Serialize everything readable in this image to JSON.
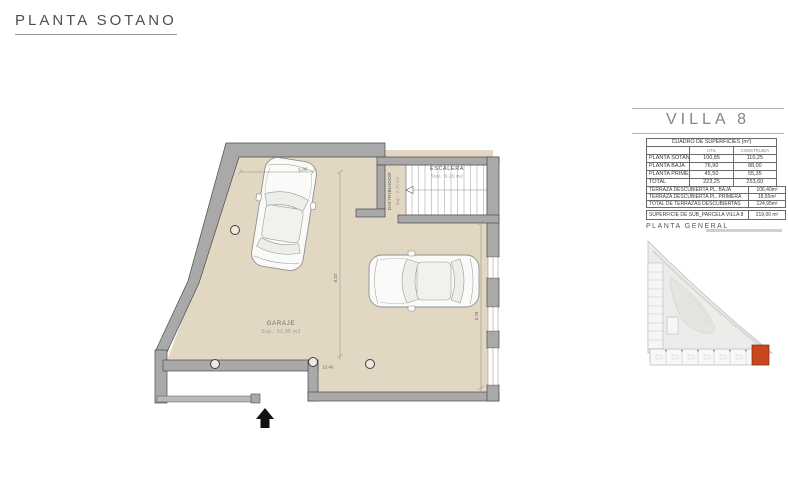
{
  "title": "PLANTA SOTANO",
  "plan": {
    "garage": {
      "label": "GARAJE",
      "area": "Sup.: 91,95 m2"
    },
    "stairs": {
      "label": "ESCALERA",
      "area": "Sup.: 6,20  m2"
    },
    "hall": {
      "label": "DISTRIBUIDOR",
      "area": "Sup.: 2,70 m2"
    },
    "dims": {
      "top": "5.00",
      "mid_vertical": "8.23",
      "right_vertical": "6.78",
      "bottom": "13.40"
    }
  },
  "panel": {
    "villa_title": "VILLA 8",
    "surfaces": {
      "header": "CUADRO DE SUPERFICIES (m²)",
      "columns": {
        "util": "UTIL",
        "construida": "CONSTRUIDA"
      },
      "rows": [
        {
          "label": "PLANTA SOTANO",
          "util": "100,85",
          "construida": "110,25"
        },
        {
          "label": "PLANTA BAJA",
          "util": "76,90",
          "construida": "88,00"
        },
        {
          "label": "PLANTA PRIMERA",
          "util": "45,50",
          "construida": "55,35"
        },
        {
          "label": "TOTAL",
          "util": "223,25",
          "construida": "253,60"
        }
      ]
    },
    "terraces": {
      "rows": [
        {
          "label": "TERRAZA DESCUBIERTA PL. BAJA",
          "value": "106,40m²"
        },
        {
          "label": "TERRAZA DESCUBIERTA PL. PRIMERA",
          "value": "18,55m²"
        },
        {
          "label": "TOTAL DE TERRAZAS DESCUBIERTAS",
          "value": "124,95m²"
        }
      ]
    },
    "parcel": {
      "label": "SUPERFICIE DE SUB_PARCELA VILLA 8",
      "value": "219,00 m²"
    },
    "site_plan_title": "PLANTA GENERAL"
  },
  "colors": {
    "floor": "#e1d7c2",
    "wall": "#a9a9a9",
    "wall_edge": "#4a4a4a",
    "highlight_villa": "#c9471d",
    "plot": "#ececea"
  }
}
